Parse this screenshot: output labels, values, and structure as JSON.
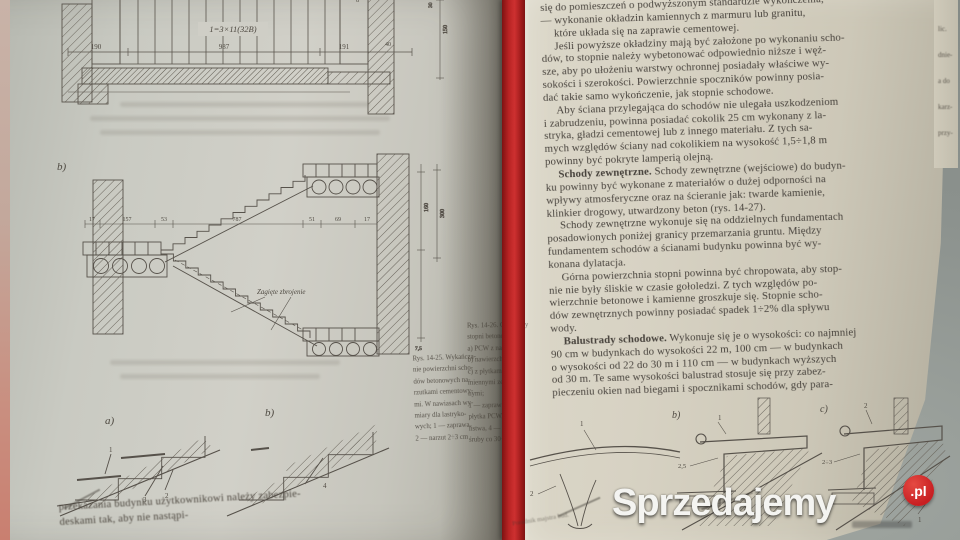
{
  "watermark": {
    "brand": "Sprzedajemy",
    "tld": ".pl"
  },
  "colors": {
    "ribbon_red": "#b92424",
    "watermark_red": "#c81f22",
    "page_left": "#cccbc3",
    "page_right": "#d5d0c1",
    "table_gray": "#8b918d",
    "ink": "#46413b"
  },
  "left_page": {
    "fig_top": {
      "plan_label": "1=3×11(32B)",
      "dims": [
        "190",
        "987",
        "191",
        "40"
      ],
      "side_dim": "8",
      "vert_dim_a": "150",
      "vert_dim_b": "30"
    },
    "fig_mid": {
      "label": "b)",
      "dims": [
        "17",
        "157",
        "53",
        "787",
        "51",
        "69",
        "17"
      ],
      "note": "Zagięte zbrojenie",
      "vdim_a": "160",
      "vdim_b": "300",
      "vdim_c": "7,5"
    },
    "details": {
      "label_a": "a)",
      "label_b": "b)",
      "a_n1": "1",
      "a_n2": "2",
      "a_n3": "3",
      "b_n4": "4"
    },
    "caption_lines": [
      "Rys. 14-25. Wykańcza-",
      "nie powierzchni scho-",
      "dów betonowych na-",
      "rzutkami cementowy-",
      "mi. W nawiasach wy-",
      "miary dla lastryko-",
      "wych; 1 — zaprawa,",
      "2 — narzut 2÷3 cm"
    ],
    "bottom_lines": [
      "przekazania budynku użytkownikowi należy zabezpie-",
      "deskami tak, aby nie nastąpi-"
    ]
  },
  "right_page": {
    "lines": [
      {
        "t": "się do pomieszczeń o podwyższonym standardzie wykończenia,"
      },
      {
        "t": "— wykonanie okładzin kamiennych z marmuru lub granitu,"
      },
      {
        "t": "które układa się na zaprawie cementowej.",
        "in": 1
      },
      {
        "t": "Jeśli powyższe okładziny mają być założone po wykonaniu scho-",
        "in": 1
      },
      {
        "t": "dów, to stopnie należy wybetonować odpowiednio niższe i węż-"
      },
      {
        "t": "sze, aby po ułożeniu warstwy ochronnej posiadały właściwe wy-"
      },
      {
        "t": "sokości i szerokości. Powierzchnie spoczników powinny posia-"
      },
      {
        "t": "dać takie samo wykończenie, jak stopnie schodowe."
      },
      {
        "t": "Aby ściana przylegająca do schodów nie ulegała uszkodzeniom",
        "in": 1
      },
      {
        "t": "i zabrudzeniu, powinna posiadać cokolik 25 cm wykonany z la-"
      },
      {
        "t": "stryka, gładzi cementowej lub z innego materiału. Z tych sa-"
      },
      {
        "t": "mych względów ściany nad cokolikiem na wysokość 1,5÷1,8 m"
      },
      {
        "t": "powinny być pokryte lamperią olejną."
      },
      {
        "b": "Schody zewnętrzne.",
        "t": " Schody zewnętrzne (wejściowe) do budyn-",
        "in": 1
      },
      {
        "t": "ku powinny być wykonane z materiałów o dużej odporności na"
      },
      {
        "t": "wpływy atmosferyczne oraz na ścieranie jak: twarde kamienie,"
      },
      {
        "t": "klinkier drogowy, utwardzony beton (rys. 14-27)."
      },
      {
        "t": "Schody zewnętrzne wykonuje się na oddzielnych fundamentach",
        "in": 1
      },
      {
        "t": "posadowionych poniżej granicy przemarzania gruntu. Między"
      },
      {
        "t": "fundamentem schodów a ścianami budynku powinna być wy-"
      },
      {
        "t": "konana dylatacja."
      },
      {
        "t": "Górna powierzchnia stopni powinna być chropowata, aby stop-",
        "in": 1
      },
      {
        "t": "nie nie były śliskie w czasie gołoledzi. Z tych względów po-"
      },
      {
        "t": "wierzchnie betonowe i kamienne groszkuje się. Stopnie scho-"
      },
      {
        "t": "dów zewnętrznych powinny posiadać spadek 1÷2% dla spływu"
      },
      {
        "t": "wody."
      },
      {
        "b": "Balustrady schodowe.",
        "t": " Wykonuje się je o wysokości: co najmniej",
        "in": 1
      },
      {
        "t": "90 cm w budynkach do wysokości 22 m, 100 cm — w budynkach"
      },
      {
        "t": "o wysokości od 22 do 30 m i 110 cm — w budynkach wyższych"
      },
      {
        "t": "od 30 m. Te same wysokości balustrad stosuje się przy zabez-"
      },
      {
        "t": "pieczeniu okien nad biegami i spocznikami schodów, gdy para-"
      }
    ],
    "margin_caption_lines": [
      "Rys. 14-26. Okładziny",
      "stopni betonowych:",
      "a) PCW z narzutką,",
      "b) nawierzchniowe,",
      "c) z płytkami ka-",
      "miennymi zewnętrz-",
      "nymi;",
      "1 — zaprawa, 2 —",
      "płytka PCW, 3 —",
      "listwa, 4 — wkręt,",
      "śruby co 30÷40 cm"
    ],
    "edge_fragments": [
      "lic.",
      "dnie-",
      "a do",
      "karz-",
      "przy-"
    ],
    "footer": "Poradnik majstra bud.",
    "fig_details": {
      "d1_n1": "1",
      "d1_n2": "2",
      "d2_label": "b)",
      "d2_n1": "1",
      "d2_n25": "2,5",
      "d2_n3": "3",
      "d3_label": "c)",
      "d3_n2": "2",
      "d3_n23": "2÷3",
      "d3_n1": "1"
    }
  }
}
